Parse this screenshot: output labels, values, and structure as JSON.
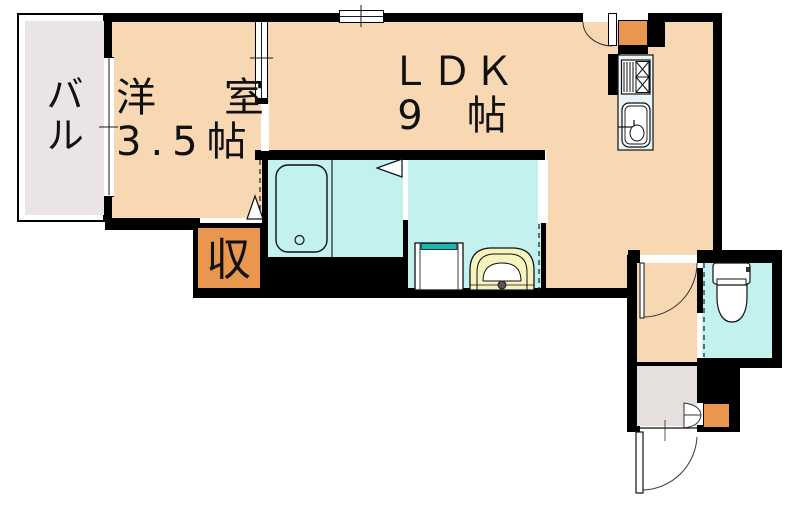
{
  "plan_title": "1LDK apartment floor plan",
  "rooms": {
    "balcony": {
      "label": "バル"
    },
    "western_room": {
      "label": "洋　室",
      "size": "3.5帖"
    },
    "ldk": {
      "label": "ＬＤＫ",
      "size": "9　帖"
    },
    "storage": {
      "label": "収"
    }
  },
  "fixtures": [
    "bathtub",
    "washing-machine-pan",
    "washbasin",
    "toilet",
    "gas-stove",
    "kitchen-sink",
    "entrance-door",
    "hallway-door",
    "ldk-service-door",
    "bifold-shoe-cabinet-door",
    "sliding-room-door",
    "window-top",
    "window-balcony"
  ],
  "colors": {
    "wall": "#000000",
    "room": "#F8D7B3",
    "wet": "#C2F1F0",
    "balcony": "#EAE5E4",
    "genkan": "#E5DFDE",
    "storage": "#E9964F",
    "basin": "#F7F3BE",
    "teal": "#1AB5B5",
    "kitchen": "#E9F4F9",
    "line": "#1a1a1a"
  }
}
